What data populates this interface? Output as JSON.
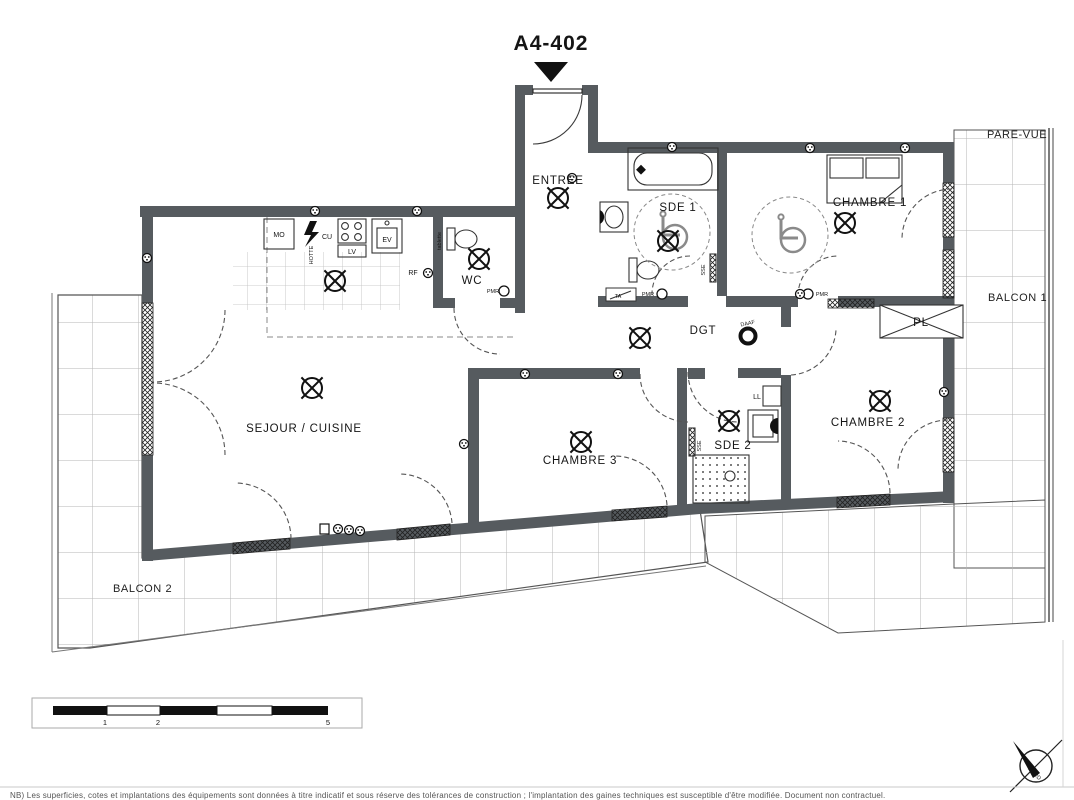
{
  "title": "A4-402",
  "rooms": {
    "entree": "ENTREE",
    "wc": "WC",
    "sde1": "SDE 1",
    "chambre1": "CHAMBRE 1",
    "dgt": "DGT",
    "pl": "PL",
    "sejour_cuisine": "SEJOUR / CUISINE",
    "chambre3": "CHAMBRE 3",
    "sde2": "SDE 2",
    "chambre2": "CHAMBRE 2"
  },
  "outdoor": {
    "pare_vue": "PARE-VUE",
    "balcon1": "BALCON 1",
    "balcon2": "BALCON 2"
  },
  "equipment": {
    "mo": "MO",
    "cu": "CU",
    "lv": "LV",
    "ev": "EV",
    "rf": "RF",
    "ll": "LL",
    "hotte": "HOTTE",
    "tablette": "tablette"
  },
  "annotations": {
    "pmr": "PMR",
    "sse": "SSE",
    "ta": "TA",
    "daaf": "DAAF"
  },
  "compass": {
    "north": "NORD"
  },
  "scale_bar": {
    "t1": "1",
    "t2": "2",
    "t5": "5"
  },
  "footnote": "NB) Les superficies, cotes et implantations des équipements sont données à titre indicatif et sous réserve des tolérances de construction ; l'implantation des gaines techniques est susceptible d'être modifiée. Document non contractuel.",
  "colors": {
    "wall": "#565b5f",
    "line": "#2f2f2f",
    "balcony_grid": "#b5b5b5"
  }
}
